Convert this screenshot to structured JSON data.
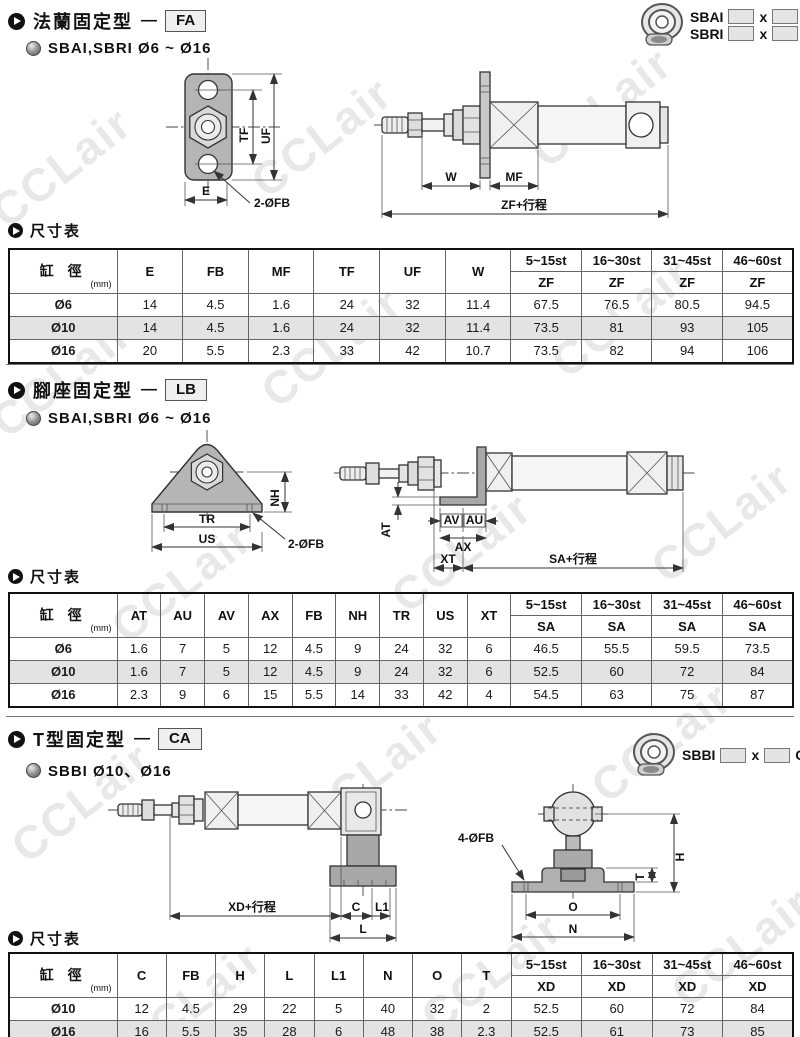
{
  "watermark": "CCLair",
  "sections": [
    {
      "title": "法蘭固定型",
      "dash": "—",
      "code": "FA",
      "subtitle": "SBAI,SBRI  Ø6 ~ Ø16",
      "models": [
        {
          "series": "SBAI",
          "x": "x",
          "mount": "FA"
        },
        {
          "series": "SBRI",
          "x": "x",
          "mount": "LB"
        }
      ],
      "table_label": "尺寸表",
      "drawing_labels": {
        "tf": "TF",
        "uf": "UF",
        "e": "E",
        "fb": "2-ØFB",
        "w": "W",
        "mf": "MF",
        "zf": "ZF+行程"
      },
      "table": {
        "bore_header": "缸 徑",
        "bore_unit": "(mm)",
        "dim_headers": [
          "E",
          "FB",
          "MF",
          "TF",
          "UF",
          "W"
        ],
        "stroke_headers": [
          "5~15st",
          "16~30st",
          "31~45st",
          "46~60st"
        ],
        "stroke_sub": "ZF",
        "rows": [
          {
            "bore": "Ø6",
            "values": [
              "14",
              "4.5",
              "1.6",
              "24",
              "32",
              "11.4",
              "67.5",
              "76.5",
              "80.5",
              "94.5"
            ],
            "shaded": false
          },
          {
            "bore": "Ø10",
            "values": [
              "14",
              "4.5",
              "1.6",
              "24",
              "32",
              "11.4",
              "73.5",
              "81",
              "93",
              "105"
            ],
            "shaded": true
          },
          {
            "bore": "Ø16",
            "values": [
              "20",
              "5.5",
              "2.3",
              "33",
              "42",
              "10.7",
              "73.5",
              "82",
              "94",
              "106"
            ],
            "shaded": false
          }
        ]
      }
    },
    {
      "title": "腳座固定型",
      "dash": "—",
      "code": "LB",
      "subtitle": "SBAI,SBRI  Ø6 ~ Ø16",
      "models": [],
      "table_label": "尺寸表",
      "drawing_labels": {
        "nh": "NH",
        "tr": "TR",
        "us": "US",
        "fb": "2-ØFB",
        "at": "AT",
        "av": "AV",
        "au": "AU",
        "ax": "AX",
        "xt": "XT",
        "sa": "SA+行程"
      },
      "table": {
        "bore_header": "缸 徑",
        "bore_unit": "(mm)",
        "dim_headers": [
          "AT",
          "AU",
          "AV",
          "AX",
          "FB",
          "NH",
          "TR",
          "US",
          "XT"
        ],
        "stroke_headers": [
          "5~15st",
          "16~30st",
          "31~45st",
          "46~60st"
        ],
        "stroke_sub": "SA",
        "rows": [
          {
            "bore": "Ø6",
            "values": [
              "1.6",
              "7",
              "5",
              "12",
              "4.5",
              "9",
              "24",
              "32",
              "6",
              "46.5",
              "55.5",
              "59.5",
              "73.5"
            ],
            "shaded": false
          },
          {
            "bore": "Ø10",
            "values": [
              "1.6",
              "7",
              "5",
              "12",
              "4.5",
              "9",
              "24",
              "32",
              "6",
              "52.5",
              "60",
              "72",
              "84"
            ],
            "shaded": true
          },
          {
            "bore": "Ø16",
            "values": [
              "2.3",
              "9",
              "6",
              "15",
              "5.5",
              "14",
              "33",
              "42",
              "4",
              "54.5",
              "63",
              "75",
              "87"
            ],
            "shaded": false
          }
        ]
      }
    },
    {
      "title": "T型固定型",
      "dash": "—",
      "code": "CA",
      "subtitle": "SBBI  Ø10、Ø16",
      "models": [
        {
          "series": "SBBI",
          "x": "x",
          "mount": "CA"
        }
      ],
      "table_label": "尺寸表",
      "drawing_labels": {
        "xd": "XD+行程",
        "c": "C",
        "l1": "L1",
        "l": "L",
        "fb": "4-ØFB",
        "h": "H",
        "t": "T",
        "o": "O",
        "n": "N"
      },
      "table": {
        "bore_header": "缸 徑",
        "bore_unit": "(mm)",
        "dim_headers": [
          "C",
          "FB",
          "H",
          "L",
          "L1",
          "N",
          "O",
          "T"
        ],
        "stroke_headers": [
          "5~15st",
          "16~30st",
          "31~45st",
          "46~60st"
        ],
        "stroke_sub": "XD",
        "rows": [
          {
            "bore": "Ø10",
            "values": [
              "12",
              "4.5",
              "29",
              "22",
              "5",
              "40",
              "32",
              "2",
              "52.5",
              "60",
              "72",
              "84"
            ],
            "shaded": false
          },
          {
            "bore": "Ø16",
            "values": [
              "16",
              "5.5",
              "35",
              "28",
              "6",
              "48",
              "38",
              "2.3",
              "52.5",
              "61",
              "73",
              "85"
            ],
            "shaded": true
          }
        ]
      }
    }
  ]
}
